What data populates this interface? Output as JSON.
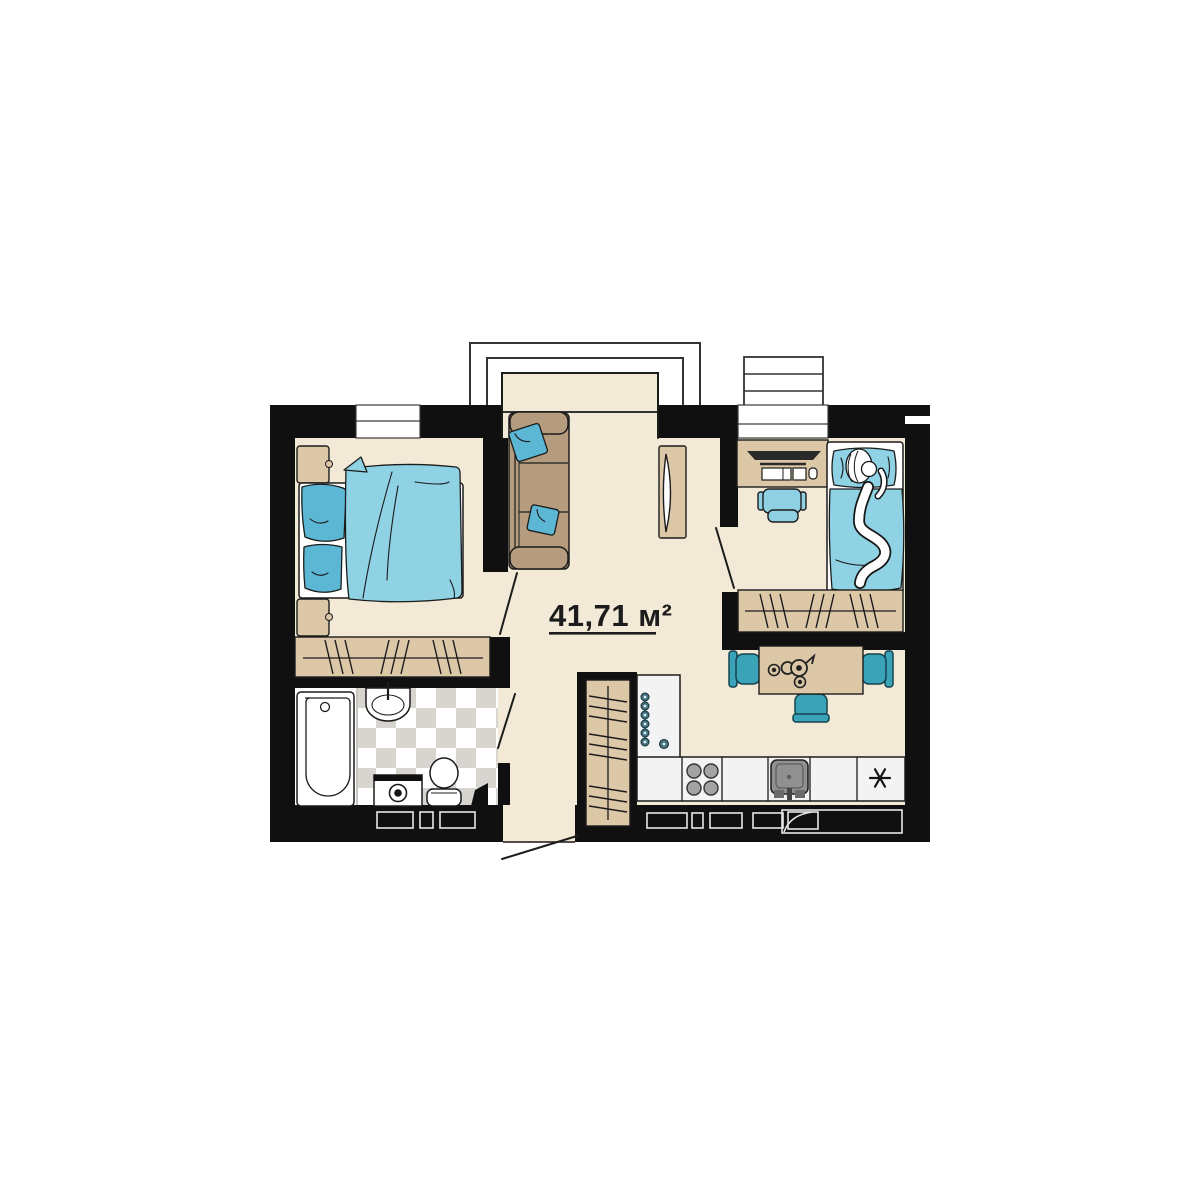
{
  "plan": {
    "area_label": "41,71 м²"
  },
  "colors": {
    "background": "#ffffff",
    "wall": "#101010",
    "floor": "#f3e9d7",
    "furniture_dark_tan": "#b59c7e",
    "furniture_tan": "#dcc7a7",
    "textile_blue": "#8ed2e4",
    "pillow_blue": "#5bb7d3",
    "chair_teal": "#3aa3b8",
    "office_chair_blue": "#8fd0e2",
    "counter": "#f3f3f3",
    "tile": "#d8d4cf",
    "metal_gray": "#a3a3a3",
    "ink": "#1c1c1c"
  },
  "icons": {
    "fridge": "asterisk-icon",
    "entry": "door-swing-icon"
  }
}
